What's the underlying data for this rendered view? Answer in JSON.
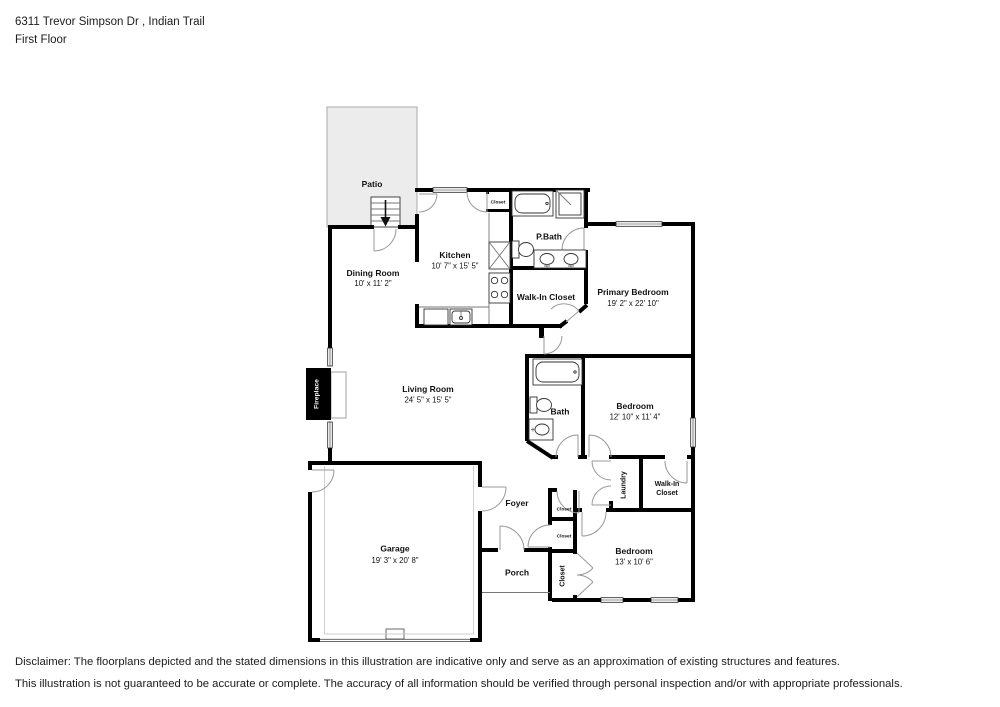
{
  "header": {
    "address_line": "6311 Trevor Simpson Dr , Indian Trail",
    "floor_line": "First Floor"
  },
  "floorplan": {
    "rooms": {
      "patio": {
        "name": "Patio"
      },
      "dining": {
        "name": "Dining Room",
        "dims": "10' x 11' 2\""
      },
      "kitchen": {
        "name": "Kitchen",
        "dims": "10' 7\" x 15' 5\""
      },
      "kitchen_closet": {
        "name": "Closet"
      },
      "pbath": {
        "name": "P.Bath"
      },
      "walkin_primary": {
        "name": "Walk-In Closet"
      },
      "primary": {
        "name": "Primary Bedroom",
        "dims": "19' 2\" x 22' 10\""
      },
      "living": {
        "name": "Living Room",
        "dims": "24' 5\" x 15' 5\""
      },
      "fireplace": {
        "name": "Fireplace"
      },
      "bath": {
        "name": "Bath"
      },
      "bedroom2": {
        "name": "Bedroom",
        "dims": "12' 10\" x 11' 4\""
      },
      "laundry": {
        "name": "Laundry"
      },
      "walkin2": {
        "line1": "Walk-In",
        "line2": "Closet"
      },
      "foyer": {
        "name": "Foyer"
      },
      "closet1": {
        "name": "Closet"
      },
      "closet2": {
        "name": "Closet"
      },
      "closet3": {
        "name": "Closet"
      },
      "bedroom3": {
        "name": "Bedroom",
        "dims": "13' x 10' 6\""
      },
      "porch": {
        "name": "Porch"
      },
      "garage": {
        "name": "Garage",
        "dims": "19' 3\" x 20' 8\""
      }
    },
    "colors": {
      "wall": "#000000",
      "patio_fill": "#ececec",
      "door_arc": "#999999",
      "fixture_stroke": "#333333"
    }
  },
  "disclaimer": {
    "line1": "Disclaimer: The floorplans depicted and the stated dimensions in this illustration are indicative only and serve as an approximation of existing structures and features.",
    "line2": "This illustration is not guaranteed to be accurate or complete. The accuracy of all information should be verified through personal inspection and/or with appropriate professionals."
  }
}
